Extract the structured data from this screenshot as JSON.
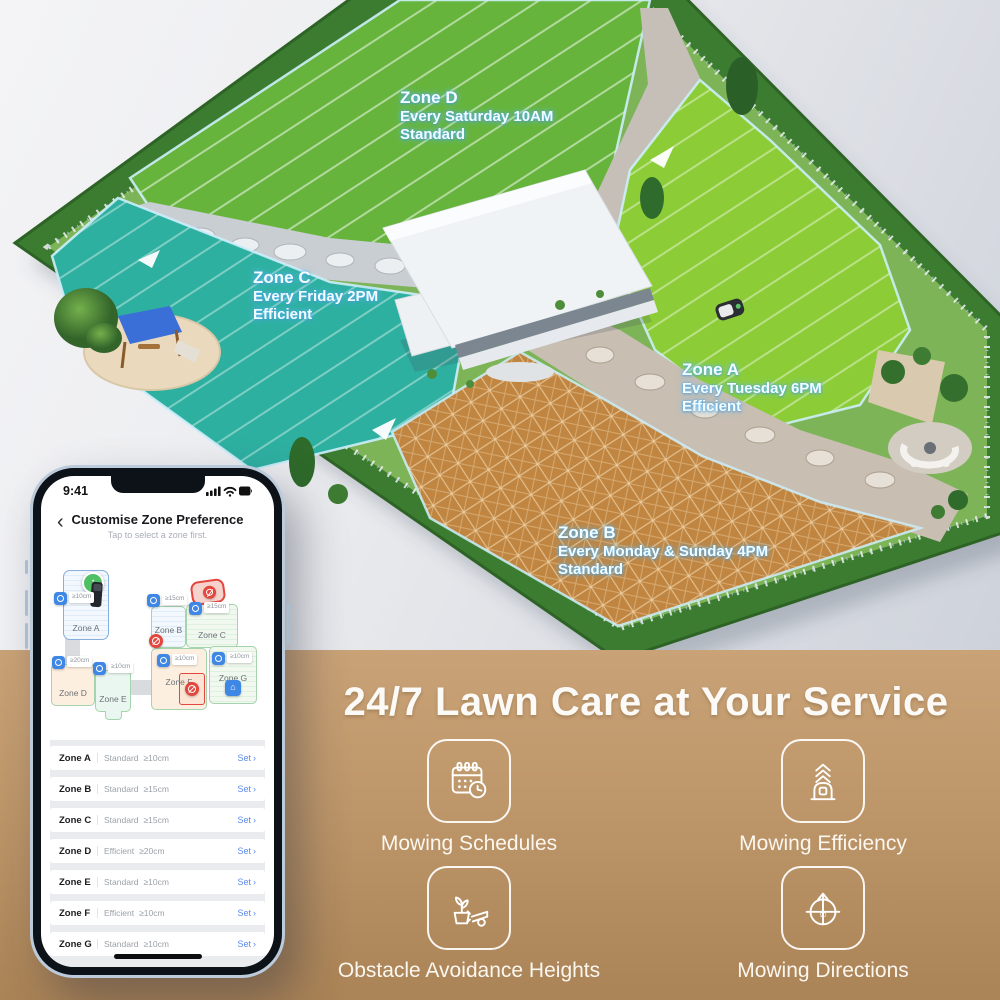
{
  "scene": {
    "zone_labels": [
      {
        "name": "Zone D",
        "schedule": "Every Saturday 10AM",
        "mode": "Standard"
      },
      {
        "name": "Zone C",
        "schedule": "Every Friday 2PM",
        "mode": "Efficient"
      },
      {
        "name": "Zone A",
        "schedule": "Every Tuesday 6PM",
        "mode": "Efficient"
      },
      {
        "name": "Zone B",
        "schedule": "Every Monday & Sunday 4PM",
        "mode": "Standard"
      }
    ]
  },
  "phone": {
    "status": {
      "time": "9:41"
    },
    "header": {
      "back": "‹",
      "title": "Customise Zone Preference",
      "subtitle": "Tap to select a zone first."
    },
    "map": {
      "zones": [
        {
          "name": "Zone A",
          "height": "≥10cm"
        },
        {
          "name": "Zone B",
          "height": "≥15cm"
        },
        {
          "name": "Zone C",
          "height": "≥15cm"
        },
        {
          "name": "Zone D",
          "height": "≥20cm"
        },
        {
          "name": "Zone E",
          "height": "≥10cm"
        },
        {
          "name": "Zone F",
          "height": "≥10cm"
        },
        {
          "name": "Zone G",
          "height": "≥10cm"
        }
      ]
    },
    "list": [
      {
        "zone": "Zone A",
        "mode": "Standard",
        "height": "≥10cm",
        "action": "Set"
      },
      {
        "zone": "Zone B",
        "mode": "Standard",
        "height": "≥15cm",
        "action": "Set"
      },
      {
        "zone": "Zone C",
        "mode": "Standard",
        "height": "≥15cm",
        "action": "Set"
      },
      {
        "zone": "Zone D",
        "mode": "Efficient",
        "height": "≥20cm",
        "action": "Set"
      },
      {
        "zone": "Zone E",
        "mode": "Standard",
        "height": "≥10cm",
        "action": "Set"
      },
      {
        "zone": "Zone F",
        "mode": "Efficient",
        "height": "≥10cm",
        "action": "Set"
      },
      {
        "zone": "Zone G",
        "mode": "Standard",
        "height": "≥10cm",
        "action": "Set"
      }
    ],
    "ui": {
      "chevron": "›"
    }
  },
  "promo": {
    "heading": "24/7 Lawn Care at Your Service",
    "features": [
      {
        "label": "Mowing Schedules",
        "icon": "calendar-clock-icon"
      },
      {
        "label": "Mowing Efficiency",
        "icon": "mower-speed-icon"
      },
      {
        "label": "Obstacle Avoidance Heights",
        "icon": "plant-mower-blade-icon"
      },
      {
        "label": "Mowing Directions",
        "icon": "direction-compass-icon",
        "value": "90"
      }
    ]
  },
  "colors": {
    "band_tan": "#bd9669",
    "accent_blue": "#3f87e5",
    "set_link_blue": "#5b8bea",
    "zone_d_green": "#66b43c",
    "zone_c_teal": "#2eb0a1",
    "zone_a_lime": "#8ccd37",
    "zone_b_orange": "#c08540",
    "nogo_red": "#e2463c",
    "dock_green": "#4fbf63"
  }
}
